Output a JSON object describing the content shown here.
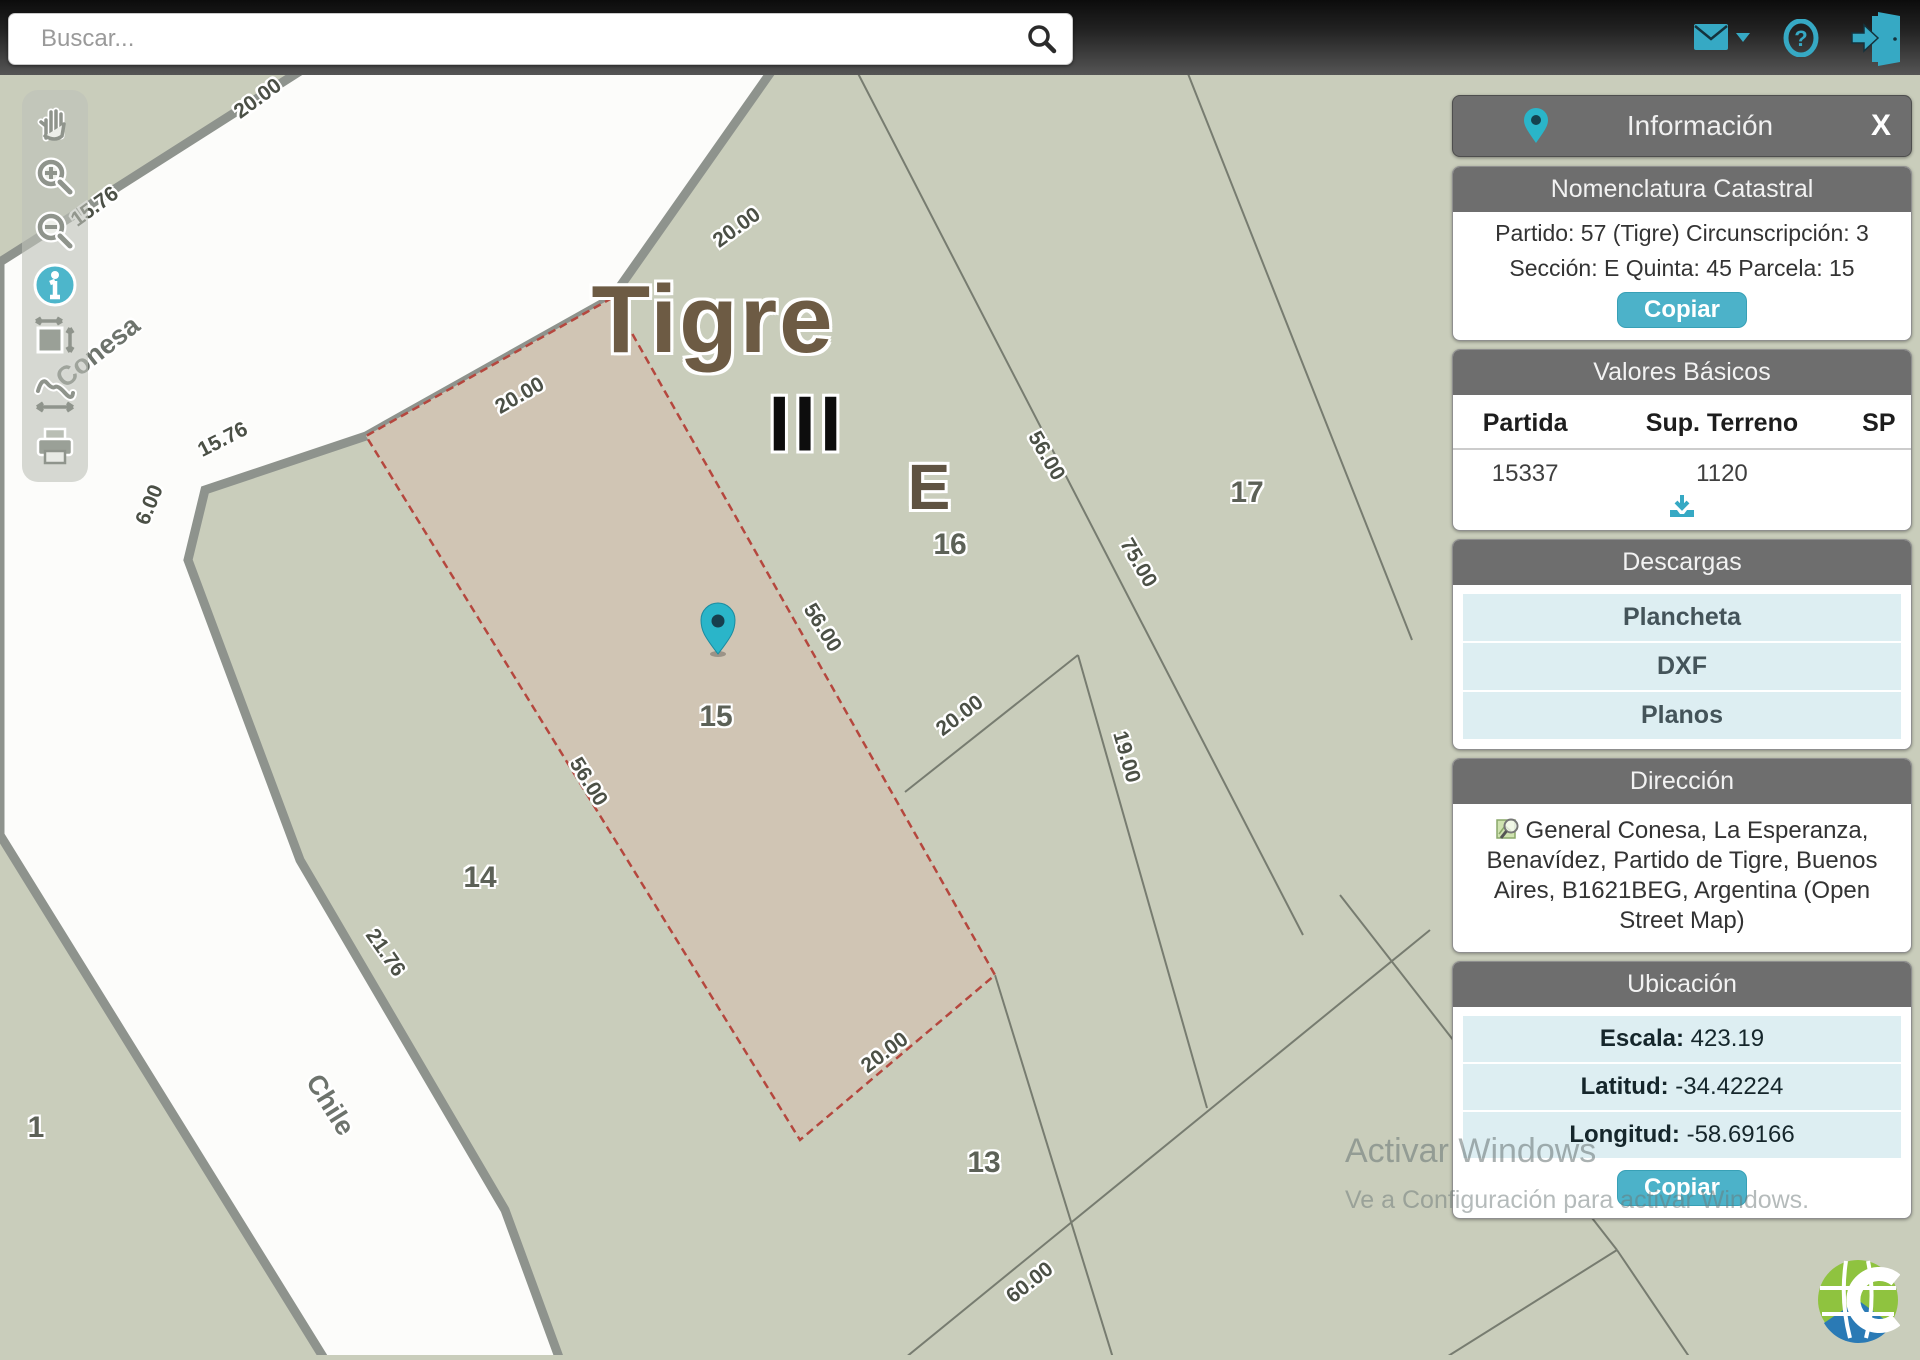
{
  "topbar": {
    "search_placeholder": "Buscar...",
    "icons": [
      "search-icon",
      "mail-icon",
      "caret-down-icon",
      "help-icon",
      "logout-icon"
    ]
  },
  "toolbar": {
    "tools": [
      "pan-tool",
      "zoom-in-tool",
      "zoom-out-tool",
      "info-tool",
      "extent-tool",
      "measure-tool",
      "print-tool"
    ]
  },
  "map": {
    "labels": [
      {
        "text": "Tigre",
        "x": 713,
        "y": 320,
        "rot": 0,
        "cls": "big1",
        "name": "map-label-tigre"
      },
      {
        "text": "III",
        "x": 807,
        "y": 424,
        "rot": 0,
        "cls": "big2",
        "name": "map-label-circunscripcion"
      },
      {
        "text": "E",
        "x": 929,
        "y": 487,
        "rot": 0,
        "cls": "big3",
        "name": "map-label-seccion"
      },
      {
        "text": "1",
        "x": 36,
        "y": 1128,
        "rot": 0,
        "cls": "parcel",
        "name": "parcel-label-1"
      },
      {
        "text": "14",
        "x": 480,
        "y": 878,
        "rot": 0,
        "cls": "parcel",
        "name": "parcel-label-14"
      },
      {
        "text": "15",
        "x": 716,
        "y": 717,
        "rot": 0,
        "cls": "parcel",
        "name": "parcel-label-15"
      },
      {
        "text": "13",
        "x": 984,
        "y": 1163,
        "rot": 0,
        "cls": "parcel",
        "name": "parcel-label-13"
      },
      {
        "text": "16",
        "x": 950,
        "y": 545,
        "rot": 0,
        "cls": "parcel",
        "name": "parcel-label-16"
      },
      {
        "text": "17",
        "x": 1247,
        "y": 493,
        "rot": 0,
        "cls": "parcel",
        "name": "parcel-label-17"
      },
      {
        "text": "Conesa",
        "x": 98,
        "y": 352,
        "rot": -38,
        "cls": "street",
        "name": "street-label-conesa"
      },
      {
        "text": "Chile",
        "x": 330,
        "y": 1105,
        "rot": 58,
        "cls": "street",
        "name": "street-label-chile"
      },
      {
        "text": "20.00",
        "x": 258,
        "y": 99,
        "rot": -36,
        "cls": "dim"
      },
      {
        "text": "15.76",
        "x": 95,
        "y": 207,
        "rot": -36,
        "cls": "dim"
      },
      {
        "text": "20.00",
        "x": 737,
        "y": 228,
        "rot": -36,
        "cls": "dim"
      },
      {
        "text": "20.00",
        "x": 520,
        "y": 396,
        "rot": -30,
        "cls": "dim"
      },
      {
        "text": "15.76",
        "x": 223,
        "y": 440,
        "rot": -27,
        "cls": "dim"
      },
      {
        "text": "6.00",
        "x": 150,
        "y": 505,
        "rot": -68,
        "cls": "dim"
      },
      {
        "text": "56.00",
        "x": 822,
        "y": 628,
        "rot": 58,
        "cls": "dim"
      },
      {
        "text": "56.00",
        "x": 588,
        "y": 782,
        "rot": 58,
        "cls": "dim"
      },
      {
        "text": "56.00",
        "x": 1046,
        "y": 456,
        "rot": 60,
        "cls": "dim"
      },
      {
        "text": "75.00",
        "x": 1138,
        "y": 563,
        "rot": 60,
        "cls": "dim"
      },
      {
        "text": "21.76",
        "x": 385,
        "y": 953,
        "rot": 55,
        "cls": "dim"
      },
      {
        "text": "20.00",
        "x": 885,
        "y": 1053,
        "rot": -37,
        "cls": "dim"
      },
      {
        "text": "20.00",
        "x": 960,
        "y": 716,
        "rot": -37,
        "cls": "dim"
      },
      {
        "text": "19.00",
        "x": 1126,
        "y": 757,
        "rot": 74,
        "cls": "dim"
      },
      {
        "text": "60.00",
        "x": 1030,
        "y": 1283,
        "rot": -38,
        "cls": "dim"
      }
    ],
    "marker": "location-pin"
  },
  "panel": {
    "title": "Información",
    "close_label": "X",
    "sections": {
      "nomenclatura": {
        "header": "Nomenclatura Catastral",
        "line1": "Partido: 57 (Tigre) Circunscripción: 3",
        "line2": "Sección: E Quinta: 45 Parcela: 15",
        "copy_label": "Copiar"
      },
      "valores": {
        "header": "Valores Básicos",
        "columns": [
          "Partida",
          "Sup. Terreno",
          "SP"
        ],
        "rows": [
          [
            "15337",
            "1120",
            ""
          ]
        ]
      },
      "descargas": {
        "header": "Descargas",
        "items": [
          "Plancheta",
          "DXF",
          "Planos"
        ]
      },
      "direccion": {
        "header": "Dirección",
        "text": "General Conesa, La Esperanza, Benavídez, Partido de Tigre, Buenos Aires, B1621BEG, Argentina (Open Street Map)"
      },
      "ubicacion": {
        "header": "Ubicación",
        "rows": [
          {
            "label": "Escala:",
            "value": "423.19"
          },
          {
            "label": "Latitud:",
            "value": "-34.42224"
          },
          {
            "label": "Longitud:",
            "value": "-58.69166"
          }
        ],
        "copy_label": "Copiar"
      }
    }
  },
  "watermark": {
    "line1": "Activar Windows",
    "line2": "Ve a Configuración para activar Windows."
  },
  "colors": {
    "accent_teal": "#36a9c4",
    "panel_gray": "#6e6e6e",
    "row_cyan": "#ddeef2",
    "map_bg": "#c9cdbb",
    "parcel_selected": "#d0c5b4",
    "parcel_border_red": "#b5473e"
  }
}
